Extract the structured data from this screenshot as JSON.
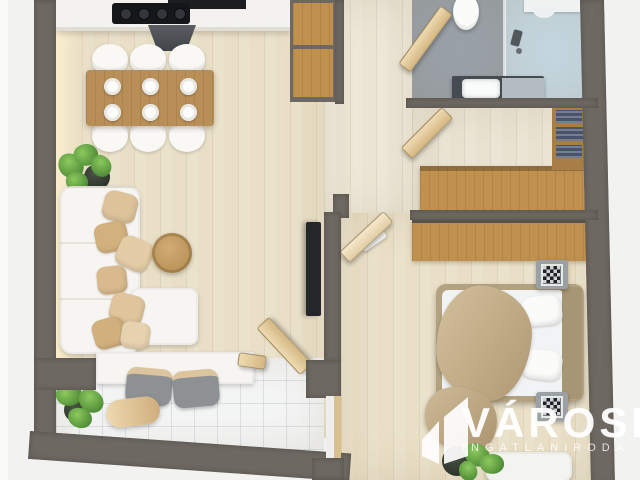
{
  "scene": {
    "title": "3D apartment floor plan render",
    "style": "top-down real-estate marketing render, cropped at top and right"
  },
  "watermark": {
    "brand": "VÁROSI",
    "tagline": "INGATLANIRODA",
    "logo": "two-building-towers-mark",
    "color": "#ffffff"
  },
  "colors": {
    "background": "#f2f2f0",
    "wall": "#6e6862",
    "wood_floor": "#e9dfc6",
    "hall_floor": "#ece6d6",
    "closet_floor": "#e9e2d0",
    "bath_floor": "#9aa1a8",
    "shower_floor": "#c4d6de",
    "balcony_tile": "#f4f5f5",
    "furniture_wood": "#c0904f",
    "table_wood": "#b98f58",
    "white_furniture": "#f6f5f1",
    "pillow_beige": "#dcc096",
    "blanket_tan": "#c7b28a",
    "plant_green": "#3c7a2b",
    "appliance_dark": "#1b1d20",
    "tv_dark": "#24262a",
    "clothes_navy": "#49536a",
    "stool_gray": "#8d9193",
    "counter_dark": "#464b52"
  },
  "rooms": [
    {
      "id": "kitchen-dining",
      "furniture": [
        "kitchen-counter",
        "cooktop",
        "extractor-hood",
        "pantry-cabinet",
        "dining-table",
        "dining-chairs-x6",
        "place-settings-x6"
      ]
    },
    {
      "id": "living-room",
      "furniture": [
        "corner-sofa",
        "throw-pillows-x7",
        "coffee-table",
        "chaise-ottoman",
        "tv",
        "potted-plant"
      ]
    },
    {
      "id": "balcony",
      "furniture": [
        "bar-counter",
        "bar-stools-x2",
        "pouf",
        "potted-plant",
        "open-door"
      ]
    },
    {
      "id": "hallway",
      "furniture": [
        "open-doors"
      ]
    },
    {
      "id": "bathroom",
      "furniture": [
        "toilet",
        "walk-in-shower",
        "glass-screen",
        "sink-vanity"
      ]
    },
    {
      "id": "closet",
      "furniture": [
        "wardrobe",
        "clothes-shelves"
      ]
    },
    {
      "id": "bedroom",
      "furniture": [
        "double-bed",
        "blanket",
        "nightstands-x2",
        "wardrobe",
        "desk",
        "potted-plant",
        "ceiling-lamp"
      ]
    }
  ]
}
